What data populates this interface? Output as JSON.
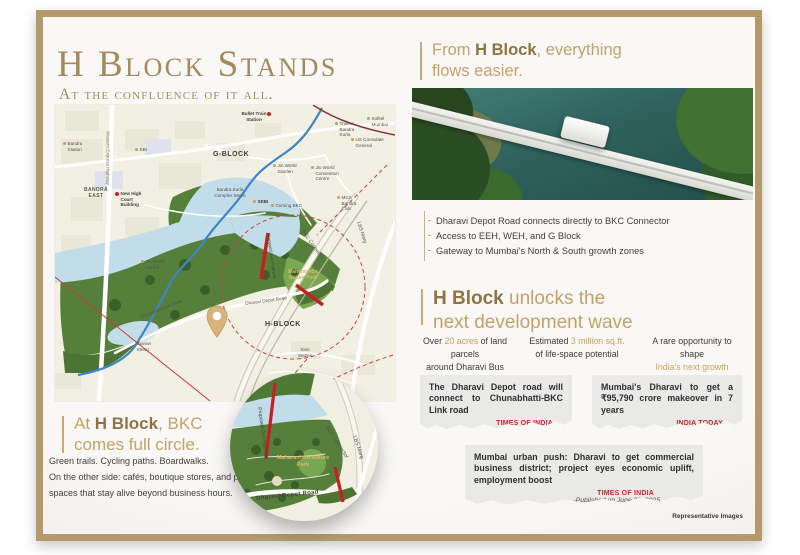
{
  "colors": {
    "frame_gold": "#b49a6b",
    "title_gold": "#a28a5a",
    "heading_gold": "#c2a268",
    "heading_bold": "#8f7342",
    "highlight_gold": "#c8a254",
    "news_red": "#c1272d",
    "park_green": "#567f3b",
    "water_blue": "#c3dce9",
    "river_blue": "#3d85c6",
    "proposed_red": "#c61f1f"
  },
  "left": {
    "title": "H Block Stands",
    "subtitle": "At the confluence of it all.",
    "callout": {
      "pre": "At ",
      "bold": "H Block",
      "post": ", BKC",
      "line2": "comes full circle."
    },
    "body_lines": [
      "Green trails. Cycling paths. Boardwalks.",
      "On the other side: cafés, boutique stores, and public",
      "spaces that stay alive beyond business hours."
    ]
  },
  "map": {
    "areas": {
      "g_block": "G-BLOCK",
      "h_block": "H-BLOCK",
      "bandra_east": "BANDRA EAST"
    },
    "landmarks": [
      {
        "name": "Bandra Station",
        "marker": "gold"
      },
      {
        "name": "SBI",
        "marker": "gold"
      },
      {
        "name": "New High Court Building",
        "marker": "red"
      },
      {
        "name": "Bullet Train Station",
        "marker": "red"
      },
      {
        "name": "Trident Bandra Kurla",
        "marker": "gold"
      },
      {
        "name": "Sofitel Mumbai",
        "marker": "gold"
      },
      {
        "name": "US Consulate General",
        "marker": "gold"
      },
      {
        "name": "Jio World Garden",
        "marker": "gold"
      },
      {
        "name": "Jio World Convention Centre",
        "marker": "gold"
      },
      {
        "name": "MCA Bandra Club",
        "marker": "gold"
      },
      {
        "name": "Bandra Kurla Complex Metro",
        "marker": "none"
      },
      {
        "name": "SEBI",
        "marker": "gold"
      },
      {
        "name": "Coming BKC",
        "marker": "gold"
      },
      {
        "name": "Jio World Centre",
        "marker": "gold"
      },
      {
        "name": "Sion Station",
        "marker": "none"
      },
      {
        "name": "Dharavi Metro",
        "marker": "none"
      }
    ],
    "roads": {
      "western_express_highway": "Western Express Highway",
      "lbs_marg": "LBS Marg",
      "bkc_connector": "BKC Connector",
      "dharavi_depot_road": "Dharavi Depot Road",
      "sion_bandra_link_road": "Sion Bandra Link Road",
      "proposed_gh_pathway": "Proposed G-H Pathway"
    },
    "park": "Maharashtra Nature Park"
  },
  "right": {
    "heading": {
      "pre": "From ",
      "bold": "H Block",
      "post": ", everything",
      "line2": "flows easier."
    },
    "bullets": [
      "Dharavi Depot Road connects directly to BKC Connector",
      "Access to EEH, WEH, and G Block",
      "Gateway to Mumbai's North & South growth zones"
    ],
    "unlock": {
      "bold": "H Block",
      "post": " unlocks the",
      "line2": "next development wave"
    },
    "stats": [
      {
        "p1": "Over ",
        "h1": "20 acres",
        "p2": " of land parcels",
        "p3": "around Dharavi Bus Depot",
        "h2": "",
        "p4": ""
      },
      {
        "p1": "Estimated ",
        "h1": "3 million sq.ft.",
        "p2": "",
        "p3": "of life-space potential",
        "h2": "",
        "p4": ""
      },
      {
        "p1": "A rare opportunity to shape",
        "h1": "",
        "p2": "",
        "p3": "",
        "h2": "India's next growth",
        "p4": " chapter"
      }
    ],
    "news": [
      {
        "headline": "The Dharavi Depot road will connect to Chunabhatti-BKC Link road",
        "source": "TIMES OF INDIA",
        "published": "-Published on May 30, 2025"
      },
      {
        "headline": "Mumbai's Dharavi to get a ₹95,790 crore makeover in 7 years",
        "source": "INDIA TODAY",
        "published": "-Published on May 29, 2025"
      },
      {
        "headline": "Mumbai urban push: Dharavi to get commercial business district; project eyes economic uplift, employment boost",
        "source": "TIMES OF INDIA",
        "published": "-Published on June 30, 2025"
      }
    ]
  },
  "footer": {
    "note": "Representative Images"
  }
}
